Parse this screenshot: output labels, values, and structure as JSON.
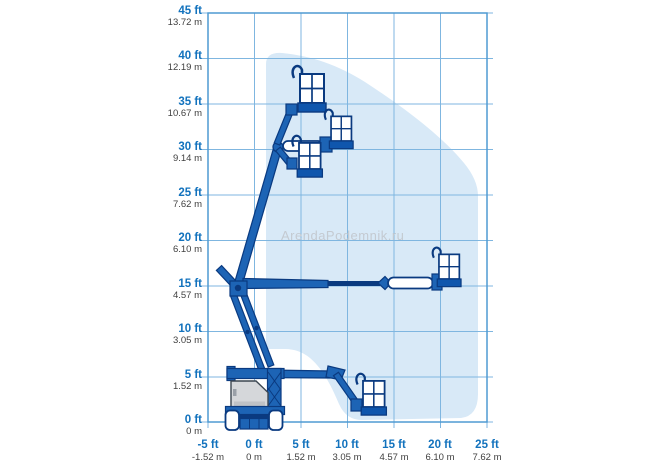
{
  "watermark": "ArendaPodemnik.ru",
  "colors": {
    "grid": "#7fb6e0",
    "border": "#4f9ad2",
    "envelope": "#d8e9f7",
    "machine_blue": "#1d64b5",
    "machine_navy": "#0a3a80",
    "basket_floor": "#0f56ad",
    "body_gray": "#d5d7da",
    "label_blue": "#1272bd",
    "label_gray": "#404040",
    "watermark_gray": "#c4cad1"
  },
  "axes": {
    "y": [
      {
        "ft": "45 ft",
        "m": "13.72 m"
      },
      {
        "ft": "40 ft",
        "m": "12.19 m"
      },
      {
        "ft": "35 ft",
        "m": "10.67 m"
      },
      {
        "ft": "30 ft",
        "m": "9.14 m"
      },
      {
        "ft": "25 ft",
        "m": "7.62 m"
      },
      {
        "ft": "20 ft",
        "m": "6.10 m"
      },
      {
        "ft": "15 ft",
        "m": "4.57 m"
      },
      {
        "ft": "10 ft",
        "m": "3.05 m"
      },
      {
        "ft": "5 ft",
        "m": "1.52 m"
      },
      {
        "ft": "0 ft",
        "m": "0 m"
      }
    ],
    "x": [
      {
        "ft": "-5 ft",
        "m": "-1.52 m"
      },
      {
        "ft": "0 ft",
        "m": "0 m"
      },
      {
        "ft": "5 ft",
        "m": "1.52 m"
      },
      {
        "ft": "10 ft",
        "m": "3.05 m"
      },
      {
        "ft": "15 ft",
        "m": "4.57 m"
      },
      {
        "ft": "20 ft",
        "m": "6.10 m"
      },
      {
        "ft": "25 ft",
        "m": "7.62 m"
      }
    ]
  },
  "chart_data": {
    "type": "area",
    "title": "Articulated boom lift working envelope (range of motion diagram)",
    "xlabel": "Horizontal reach",
    "ylabel": "Platform height",
    "x_ticks_ft": [
      -5,
      0,
      5,
      10,
      15,
      20,
      25
    ],
    "x_ticks_m": [
      -1.52,
      0,
      1.52,
      3.05,
      4.57,
      6.1,
      7.62
    ],
    "y_ticks_ft": [
      0,
      5,
      10,
      15,
      20,
      25,
      30,
      35,
      40,
      45
    ],
    "y_ticks_m": [
      0,
      1.52,
      3.05,
      4.57,
      6.1,
      7.62,
      9.14,
      10.67,
      12.19,
      13.72
    ],
    "xlim_ft": [
      -5,
      25
    ],
    "ylim_ft": [
      0,
      45
    ],
    "grid": true,
    "legend": false,
    "envelope_outline_ft": [
      [
        1.2,
        40.7
      ],
      [
        3.0,
        40.6
      ],
      [
        8.1,
        39.8
      ],
      [
        13.5,
        36.5
      ],
      [
        17.3,
        33.8
      ],
      [
        21.0,
        29.9
      ],
      [
        24.0,
        24.6
      ],
      [
        24.0,
        3.0
      ],
      [
        22.3,
        0.4
      ],
      [
        11.5,
        0.2
      ],
      [
        8.9,
        2.4
      ],
      [
        6.0,
        6.6
      ],
      [
        3.4,
        7.9
      ],
      [
        1.2,
        7.9
      ]
    ],
    "platform_positions_shown_ft": [
      {
        "label": "max height, jib raised",
        "reach": 6.3,
        "height": 34.6
      },
      {
        "label": "max height, jib horizontal",
        "reach": 9.3,
        "height": 30.5
      },
      {
        "label": "max height, jib lowered",
        "reach": 6.0,
        "height": 27.4
      },
      {
        "label": "max outreach",
        "reach": 21.0,
        "height": 15.3
      },
      {
        "label": "low drive position",
        "reach": 12.8,
        "height": 1.2
      }
    ]
  }
}
